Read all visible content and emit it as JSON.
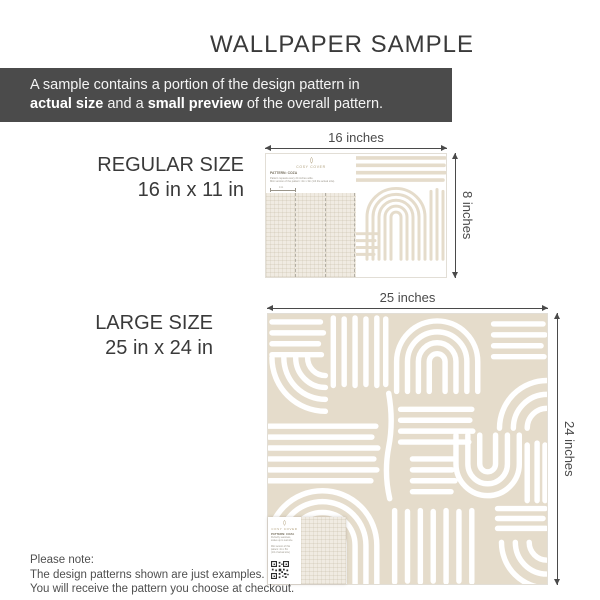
{
  "title": "WALLPAPER SAMPLE",
  "banner": {
    "line1": "A sample contains a portion of the design pattern in",
    "bold1": "actual size",
    "mid1": " and a ",
    "bold2": "small preview",
    "tail": " of the overall pattern."
  },
  "regular": {
    "label_line1": "REGULAR SIZE",
    "label_line2": "16 in x 11 in",
    "width_dim": "16 inches",
    "height_dim": "8 inches",
    "card": {
      "brand": "COSY COVER",
      "pattern_label": "PATTERN: COZA",
      "note1": "Pattern repeats every 24 inches wide.",
      "note2": "Mini version of the pattern: 4in x 3in (1/4 the actual size).",
      "ruler_label": "4 in"
    }
  },
  "large": {
    "label_line1": "LARGE SIZE",
    "label_line2": "25 in x 24 in",
    "width_dim": "25 inches",
    "height_dim": "24 inches",
    "card": {
      "brand": "COSY COVER",
      "pattern_label": "PATTERN: COZA",
      "line1": "Perfectly seamless,",
      "line2": "scales up to real size.",
      "line3": "Mini version of this",
      "line4": "pattern: 4in x 5in",
      "line5": "(1/4 of actual size)"
    }
  },
  "footnote": {
    "line1": "Please note:",
    "line2": "The design patterns shown are just examples.",
    "line3": "You will receive the pattern you choose at checkout."
  },
  "colors": {
    "beige": "#E5DCCB",
    "texture_bg": "#F0EBE2",
    "banner_bg": "#4B4B4B",
    "text_dark": "#3A3A3A",
    "dim": "#4A4A4A",
    "brand_gold": "#AD9C78",
    "qr": "#2A2A2A"
  }
}
